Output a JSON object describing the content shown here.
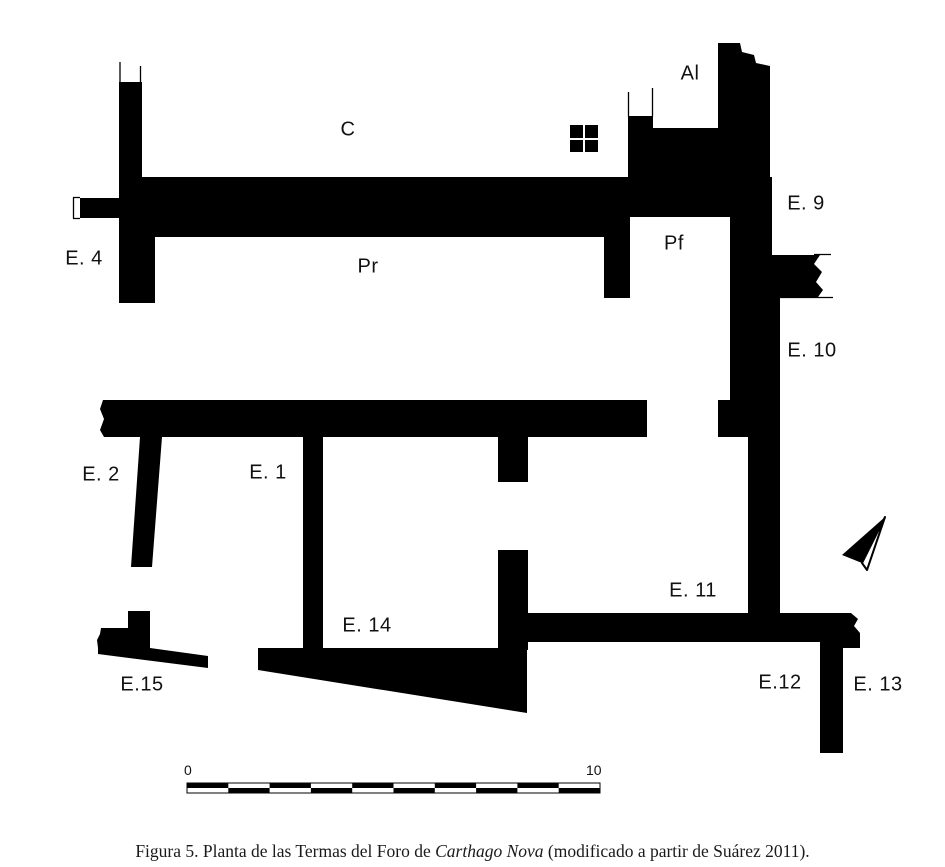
{
  "plan": {
    "labels": {
      "c": "C",
      "al": "Al",
      "e9": "E. 9",
      "e4": "E. 4",
      "pr": "Pr",
      "pf": "Pf",
      "e10": "E. 10",
      "e2": "E. 2",
      "e1": "E. 1",
      "e11": "E. 11",
      "e14": "E. 14",
      "e15": "E.15",
      "e12": "E.12",
      "e13": "E. 13"
    },
    "scale_bar": {
      "start": "0",
      "end": "10"
    },
    "colors": {
      "wall": "#000000",
      "background": "#ffffff"
    }
  },
  "caption": {
    "prefix": "Figura 5. Planta de las Termas del Foro de ",
    "italic": "Carthago Nova",
    "suffix": " (modificado a partir de Suárez 2011)."
  }
}
